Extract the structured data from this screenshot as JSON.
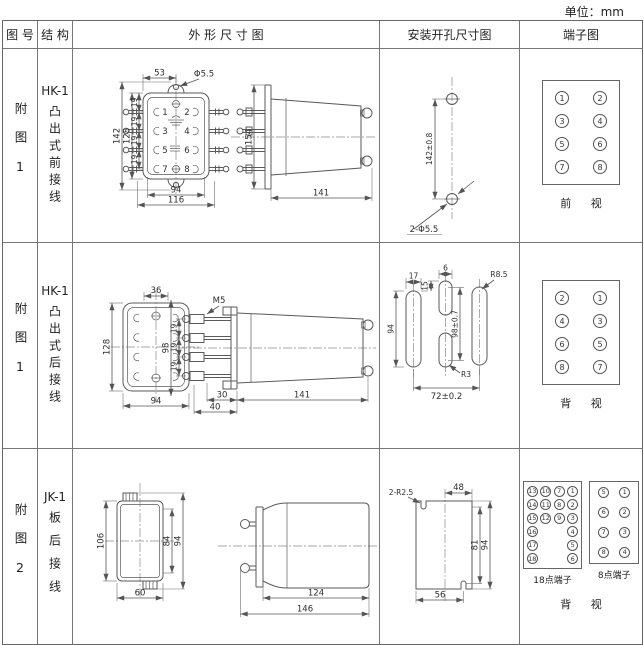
{
  "unit_label": "单位：mm",
  "table_header": {
    "figure": "图 号",
    "structure": "结 构",
    "outline": "外 形 尺 寸 图",
    "mounting": "安装开孔尺寸图",
    "terminal": "端子图"
  },
  "row1": {
    "figure": "附图1",
    "model": "HK-1",
    "type": "凸出式前接线",
    "front": {
      "dim_top": "53",
      "dim_hole": "Φ5.5",
      "dim_h_outer": "142",
      "dim_h_inner": "128",
      "dim_pitch": "19",
      "dim_w_inner": "94",
      "dim_w_outer": "116",
      "terminals": [
        "1",
        "2",
        "3",
        "4",
        "5",
        "6",
        "7",
        "8"
      ]
    },
    "side": {
      "dim_h": "154",
      "dim_w": "141"
    },
    "mounting": {
      "dim_span": "142±0.8",
      "label_holes": "2-Φ5.5"
    },
    "terminal": {
      "left": [
        "1",
        "3",
        "5",
        "7"
      ],
      "right": [
        "2",
        "4",
        "6",
        "8"
      ],
      "caption": "前 视"
    }
  },
  "row2": {
    "figure": "附图1",
    "model": "HK-1",
    "type": "凸出式后接线",
    "rear": {
      "dim_top": "36",
      "dim_h": "128",
      "dim_w": "94"
    },
    "side": {
      "label_screw": "M5",
      "dim_h": "98",
      "dim_pitch": "19",
      "dim_d1": "30",
      "dim_d2": "40",
      "dim_w": "141"
    },
    "mounting": {
      "dim_slot_w": "17",
      "dim_slot_h": "94",
      "dim_mid_w": "6",
      "dim_mid_off": "15",
      "dim_span_v": "98±0.7",
      "label_r_outer": "R8.5",
      "label_r_mid": "R3",
      "dim_span_h": "72±0.2"
    },
    "terminal": {
      "left": [
        "2",
        "4",
        "6",
        "8"
      ],
      "right": [
        "1",
        "3",
        "5",
        "7"
      ],
      "caption": "背 视"
    }
  },
  "row3": {
    "figure": "附图2",
    "model": "JK-1",
    "type": "板后接线",
    "front": {
      "dim_h": "106",
      "dim_w": "60",
      "dim_h_inner": "84",
      "dim_h_outer": "94"
    },
    "side": {
      "dim_w_inner": "124",
      "dim_w_outer": "146"
    },
    "mounting": {
      "label_r": "2-R2.5",
      "dim_top": "48",
      "dim_right_inner": "81",
      "dim_right_outer": "94",
      "dim_bottom": "56"
    },
    "terminal18": {
      "label": "18点端子",
      "col1": [
        "13",
        "14",
        "15",
        "16",
        "17",
        "18"
      ],
      "col2": [
        "10",
        "11",
        "12"
      ],
      "col3": [
        "7",
        "8",
        "9"
      ],
      "col4": [
        "1",
        "2",
        "3",
        "4",
        "5",
        "6"
      ]
    },
    "terminal8": {
      "label": "8点端子",
      "left": [
        "5",
        "6",
        "7",
        "8"
      ],
      "right": [
        "1",
        "2",
        "3",
        "4"
      ]
    },
    "caption": "背 视"
  }
}
